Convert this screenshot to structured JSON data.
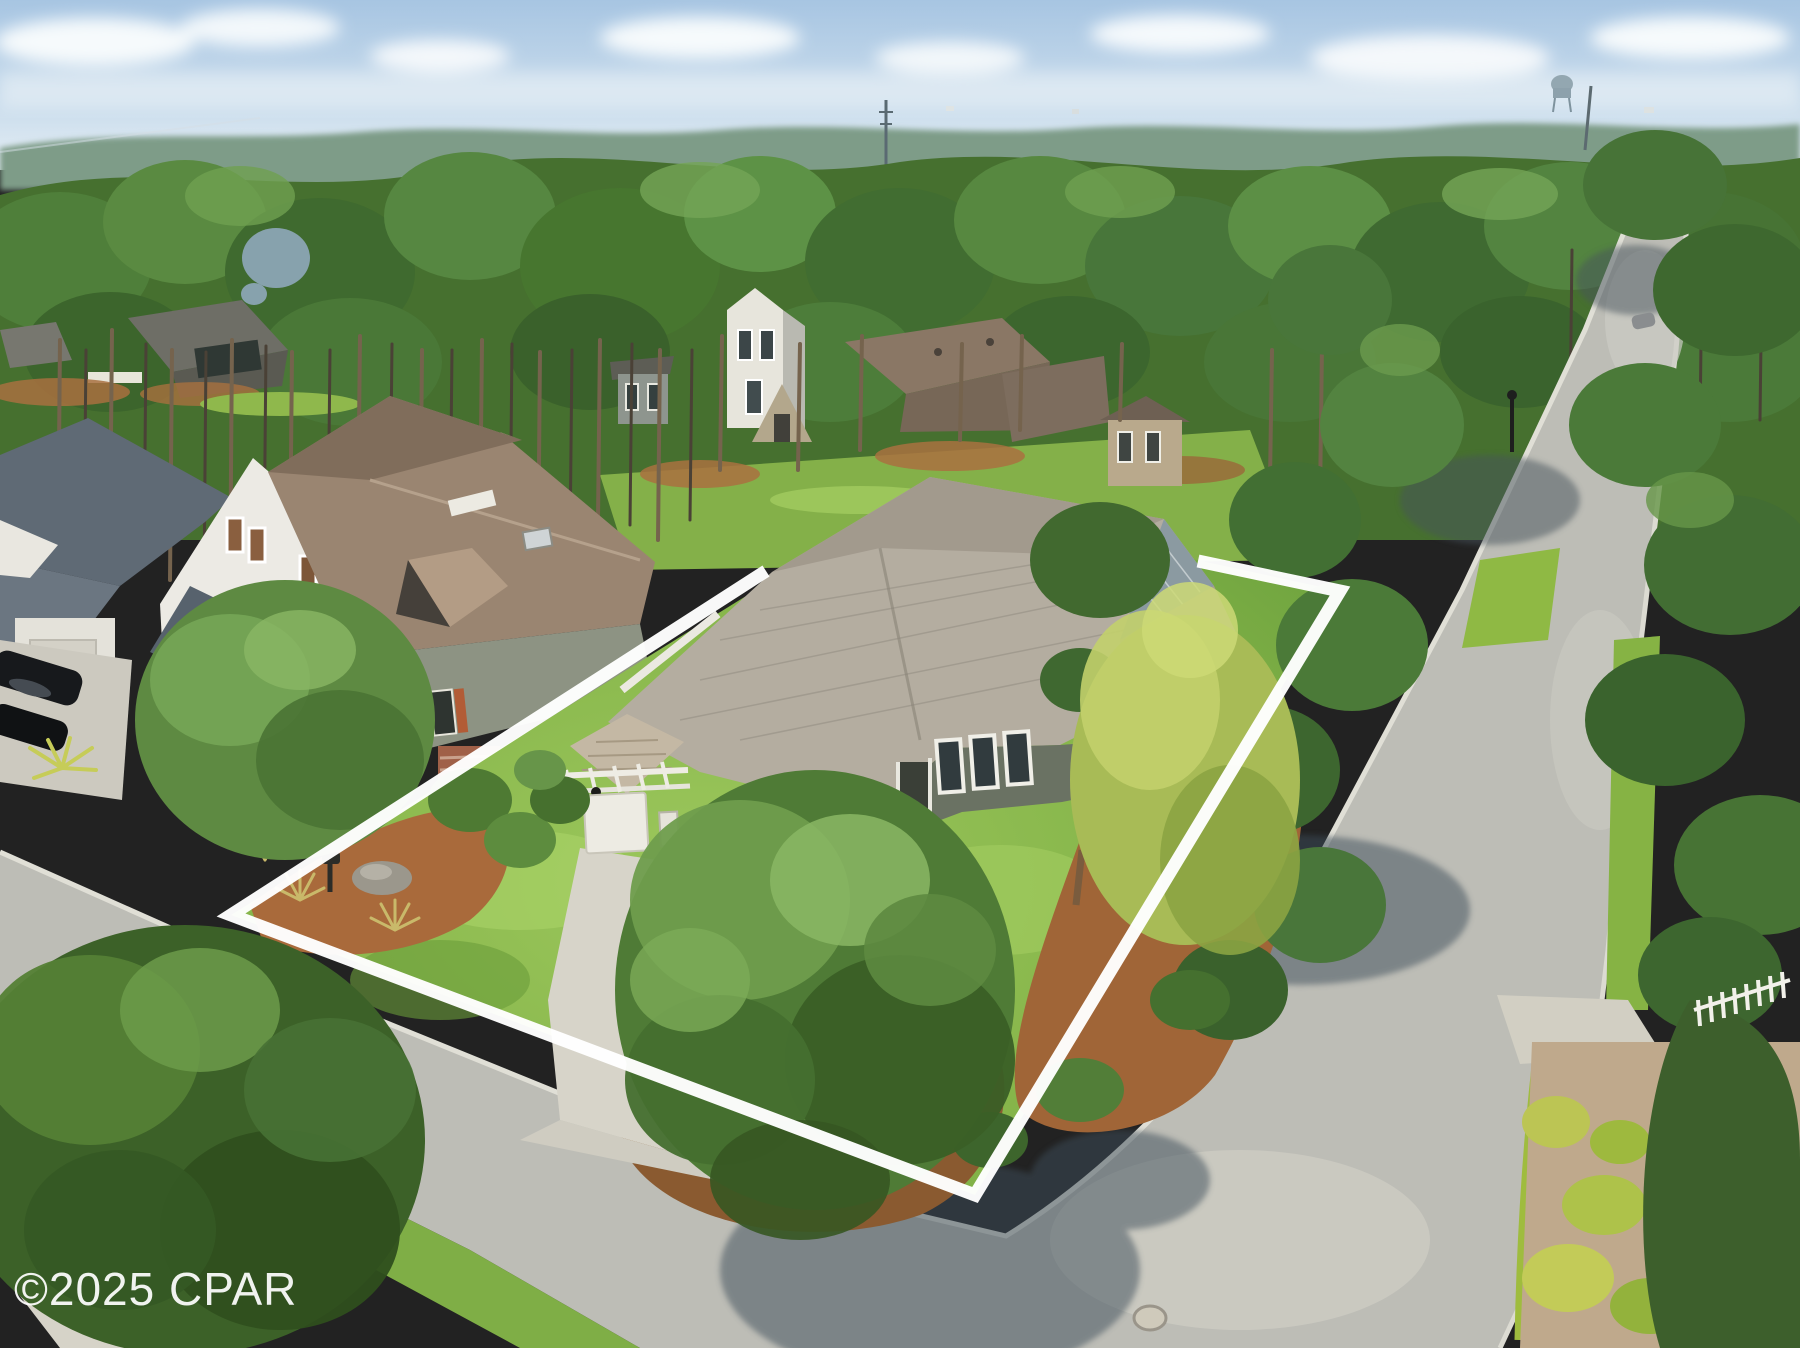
{
  "watermark": {
    "text": "©2025 CPAR"
  },
  "colors": {
    "boundary": "#ffffff",
    "watermark": "#ffffff",
    "sky_top": "#a7c5e2",
    "sky_horizon": "#e6eef5",
    "pine_green": "#4e7c38",
    "lawn_green": "#86b54a",
    "mulch_brown": "#a5693c",
    "roof_main_house": "#b4ada0",
    "roof_neighbor": "#97836f",
    "road_gray": "#bdbdb6"
  }
}
